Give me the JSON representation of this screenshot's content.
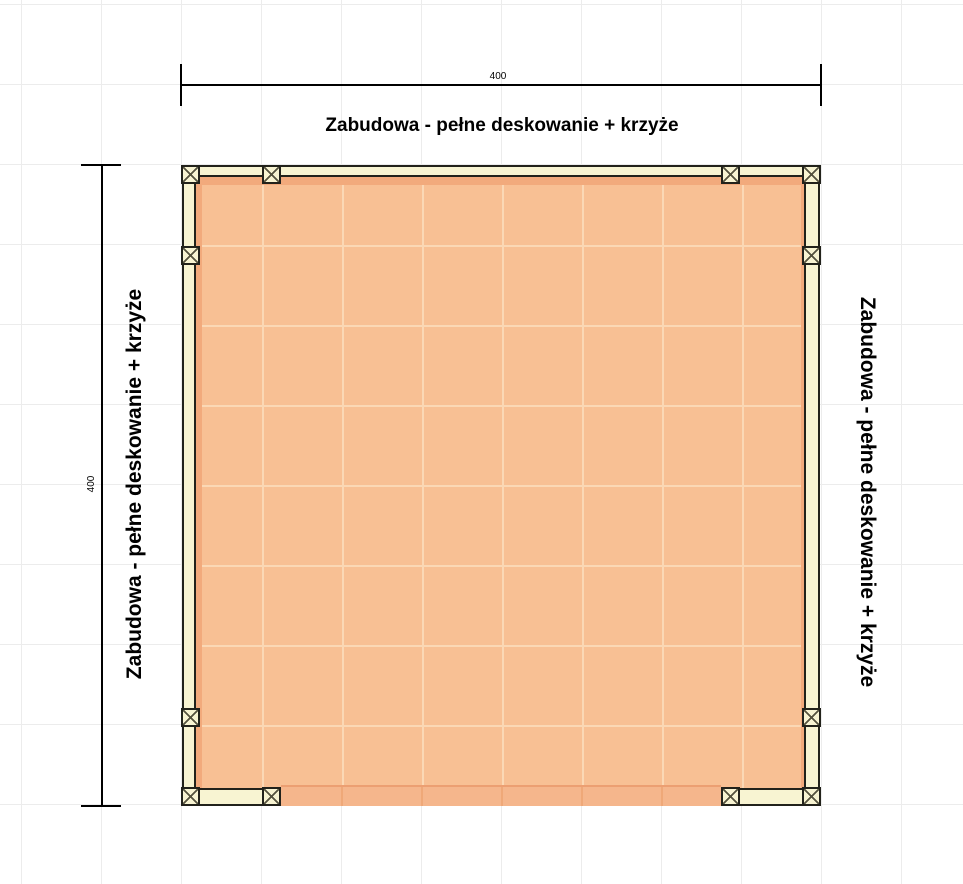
{
  "labels": {
    "top": "Zabudowa - pełne deskowanie + krzyże",
    "left": "Zabudowa - pełne deskowanie + krzyże",
    "right": "Zabudowa - pełne deskowanie + krzyże"
  },
  "dimensions": {
    "top_width": "400",
    "left_height": "400"
  },
  "colors": {
    "floor": "#f8c094",
    "floor_grid": "#fbd8b5",
    "floor_rim": "#f2aa7c",
    "deck_band": "#f5b68c",
    "deck_band_edge": "#ec9f72",
    "deck_band_line": "#efa878",
    "beam": "#f8f4d2",
    "outline": "#22221b",
    "post_cross": "#56533f",
    "dimension": "#000000",
    "text": "#000000",
    "grid": "#ececec"
  },
  "symbols": {
    "post": "square-with-diagonal-cross",
    "post_count": 12
  },
  "posts": [
    {
      "x": 181,
      "y": 165
    },
    {
      "x": 262,
      "y": 165
    },
    {
      "x": 721,
      "y": 165
    },
    {
      "x": 802,
      "y": 165
    },
    {
      "x": 181,
      "y": 246
    },
    {
      "x": 802,
      "y": 246
    },
    {
      "x": 181,
      "y": 708
    },
    {
      "x": 802,
      "y": 708
    },
    {
      "x": 181,
      "y": 787
    },
    {
      "x": 262,
      "y": 787
    },
    {
      "x": 721,
      "y": 787
    },
    {
      "x": 802,
      "y": 787
    }
  ]
}
